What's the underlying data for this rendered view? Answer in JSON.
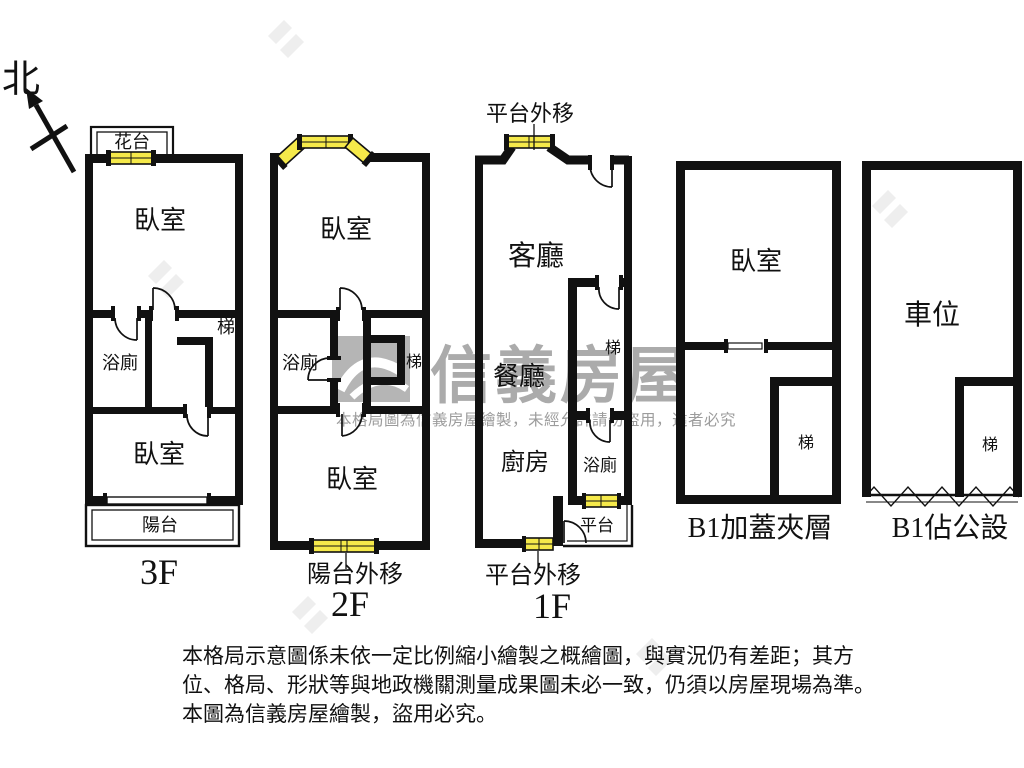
{
  "north_label": "北",
  "floors": {
    "f3": {
      "floor_label": "3F",
      "flower_bed": "花台",
      "bedroom_top": "臥室",
      "bathroom": "浴廁",
      "stairs": "梯",
      "bedroom_bottom": "臥室",
      "balcony": "陽台"
    },
    "f2": {
      "floor_label": "2F",
      "balcony_note": "陽台外移",
      "bedroom_top": "臥室",
      "bathroom": "浴廁",
      "stairs": "梯",
      "bedroom_bottom": "臥室"
    },
    "f1": {
      "floor_label": "1F",
      "platform_note_top": "平台外移",
      "platform_note_bottom": "平台外移",
      "living": "客廳",
      "dining": "餐廳",
      "kitchen": "廚房",
      "bathroom": "浴廁",
      "stairs": "梯",
      "platform": "平台"
    },
    "b1_mezzanine": {
      "floor_label": "B1加蓋夾層",
      "bedroom": "臥室",
      "stairs": "梯"
    },
    "b1_public": {
      "floor_label": "B1佔公設",
      "parking": "車位",
      "stairs": "梯"
    }
  },
  "watermark": {
    "brand": "信義房屋",
    "notice": "本格局圖為信義房屋繪製，未經允許請勿盜用，違者必究"
  },
  "disclaimer": {
    "line1": "本格局示意圖係未依一定比例縮小繪製之概繪圖，與實況仍有差距；其方",
    "line2": "位、格局、形狀等與地政機關測量成果圖未必一致，仍須以房屋現場為準。",
    "line3": "本圖為信義房屋繪製，盜用必究。"
  },
  "colors": {
    "wall": "#111111",
    "window": "#F5E94A",
    "watermark": "#ABABAB"
  }
}
